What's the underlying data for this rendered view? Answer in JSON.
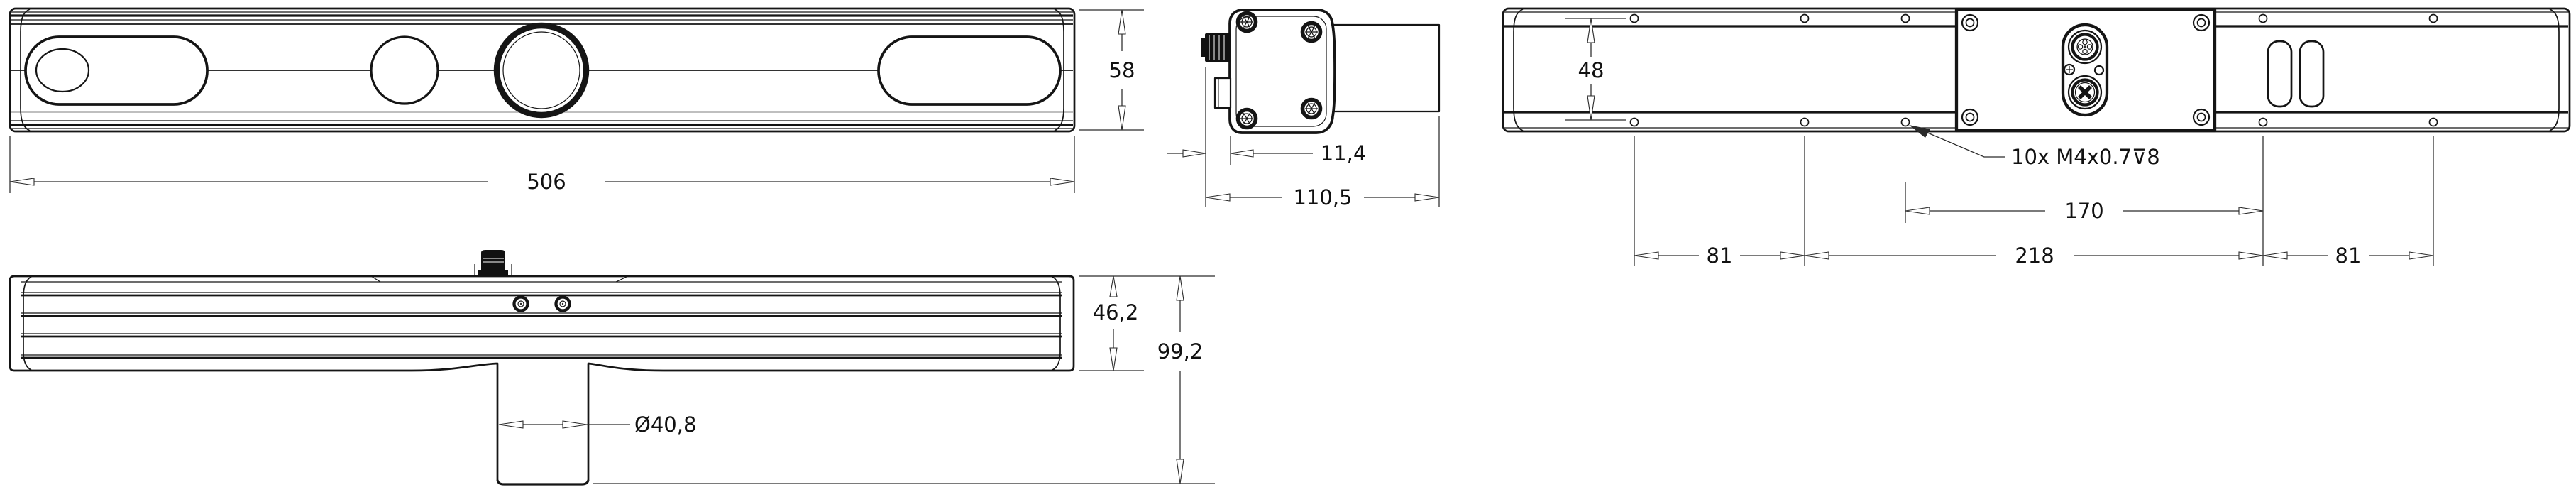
{
  "drawing": {
    "type": "engineering-dimension-drawing",
    "views": {
      "front": "front-view",
      "side": "side-view",
      "rear": "rear-view",
      "top": "top-view"
    },
    "dimensions": {
      "front_width": "506",
      "front_height": "58",
      "side_face_offset": "11,4",
      "side_total_depth": "110,5",
      "rear_hole_row_spacing": "48",
      "rear_span_inner": "170",
      "rear_span_left": "81",
      "rear_span_center": "218",
      "rear_span_right": "81",
      "thread_note": "10x M4x0.7⊽8",
      "top_body_height": "46,2",
      "top_total_height": "99,2",
      "pole_diameter": "Ø40,8"
    },
    "colors": {
      "line": "#151515",
      "dim": "#2a2a2a",
      "background": "#ffffff",
      "connector": "#111111"
    }
  }
}
